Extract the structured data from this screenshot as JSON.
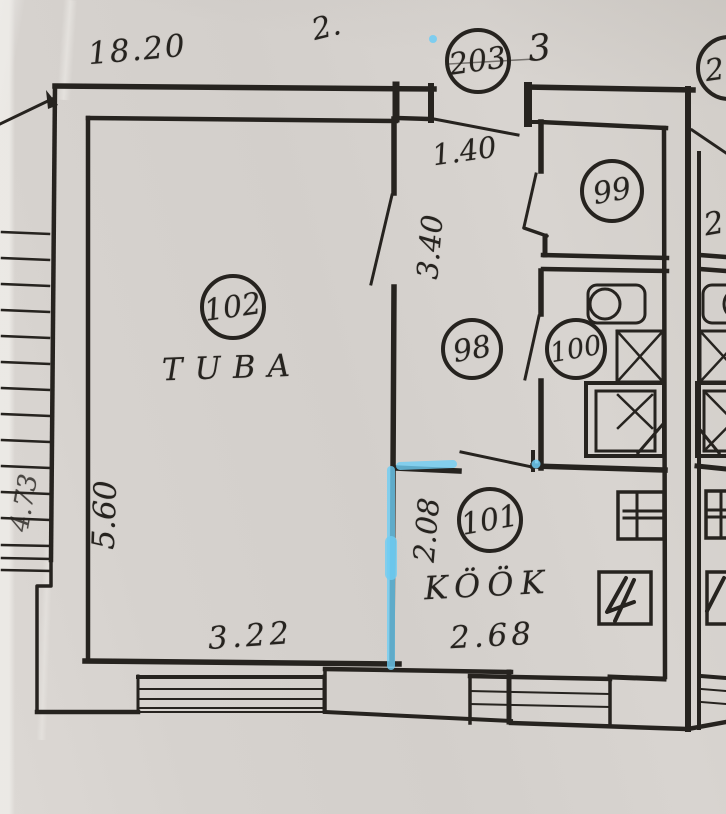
{
  "colors": {
    "paper": "#d6d2ce",
    "ink": "#26231f",
    "highlight": "#6ecdf4"
  },
  "rooms": {
    "r102": {
      "number": "102",
      "label": "TUBA"
    },
    "r98": {
      "number": "98"
    },
    "r99": {
      "number": "99"
    },
    "r100": {
      "number": "100"
    },
    "r101": {
      "number": "101",
      "label": "KÖÖK"
    },
    "r203": {
      "number": "203"
    },
    "r2": {
      "number": "2"
    }
  },
  "dimensions": {
    "top_width": "18.20",
    "entry_width": "1.40",
    "hall_depth": "3.40",
    "room_depth": "5.60",
    "room_width": "3.22",
    "kitchen_depth": "2.08",
    "kitchen_width": "2.68",
    "side_depth": "4.73"
  },
  "annotations": {
    "mark_top": "2.",
    "mark_floor": "3",
    "mark_right": "2"
  }
}
